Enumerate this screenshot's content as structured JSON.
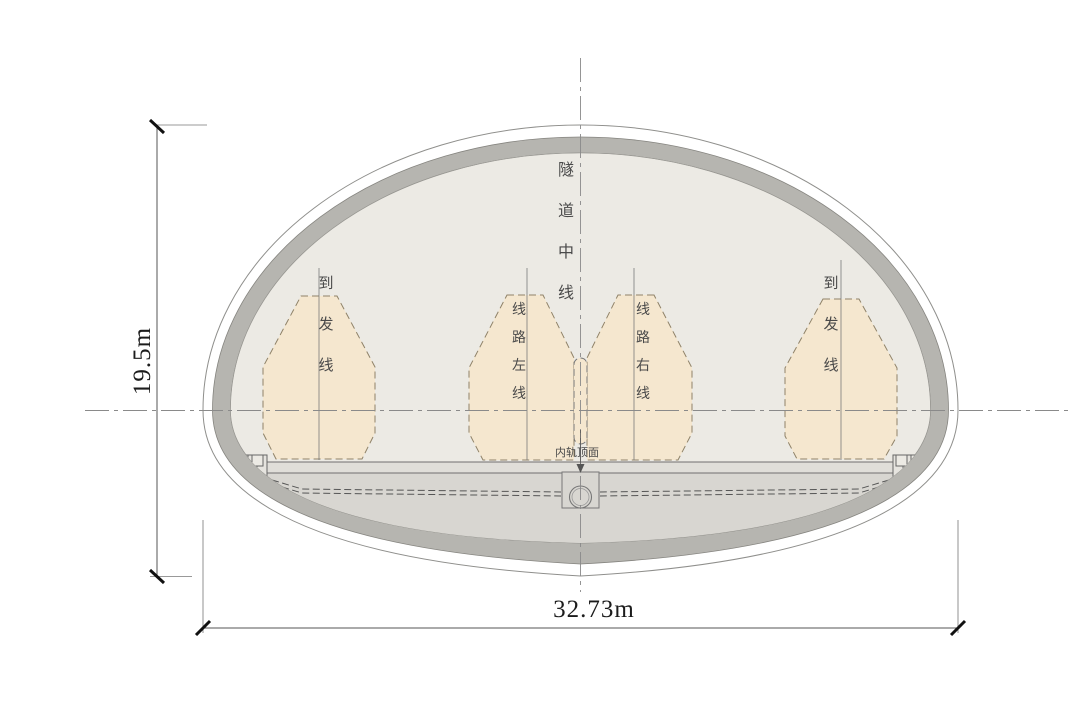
{
  "diagram": {
    "type": "railway-tunnel-cross-section",
    "dimensions": {
      "height_label": "19.5m",
      "width_label": "32.73m"
    },
    "labels": {
      "tunnel_centerline": "隧道中线",
      "arrival_departure_left": "到发线",
      "line_left": "线路左线",
      "line_right": "线路右线",
      "arrival_departure_right": "到发线",
      "inner_rail_top": "内轨顶面"
    },
    "colors": {
      "background": "#ffffff",
      "lining_gray": "#b6b5b0",
      "interior_fill": "#eceae4",
      "below_slab_fill": "#d8d6d1",
      "slab_band_fill": "#e0ded9",
      "clearance_fill": "#f5e7cf",
      "clearance_stroke": "#8f8268",
      "line_gray": "#8a8a8a",
      "dim_black": "#111111"
    }
  }
}
